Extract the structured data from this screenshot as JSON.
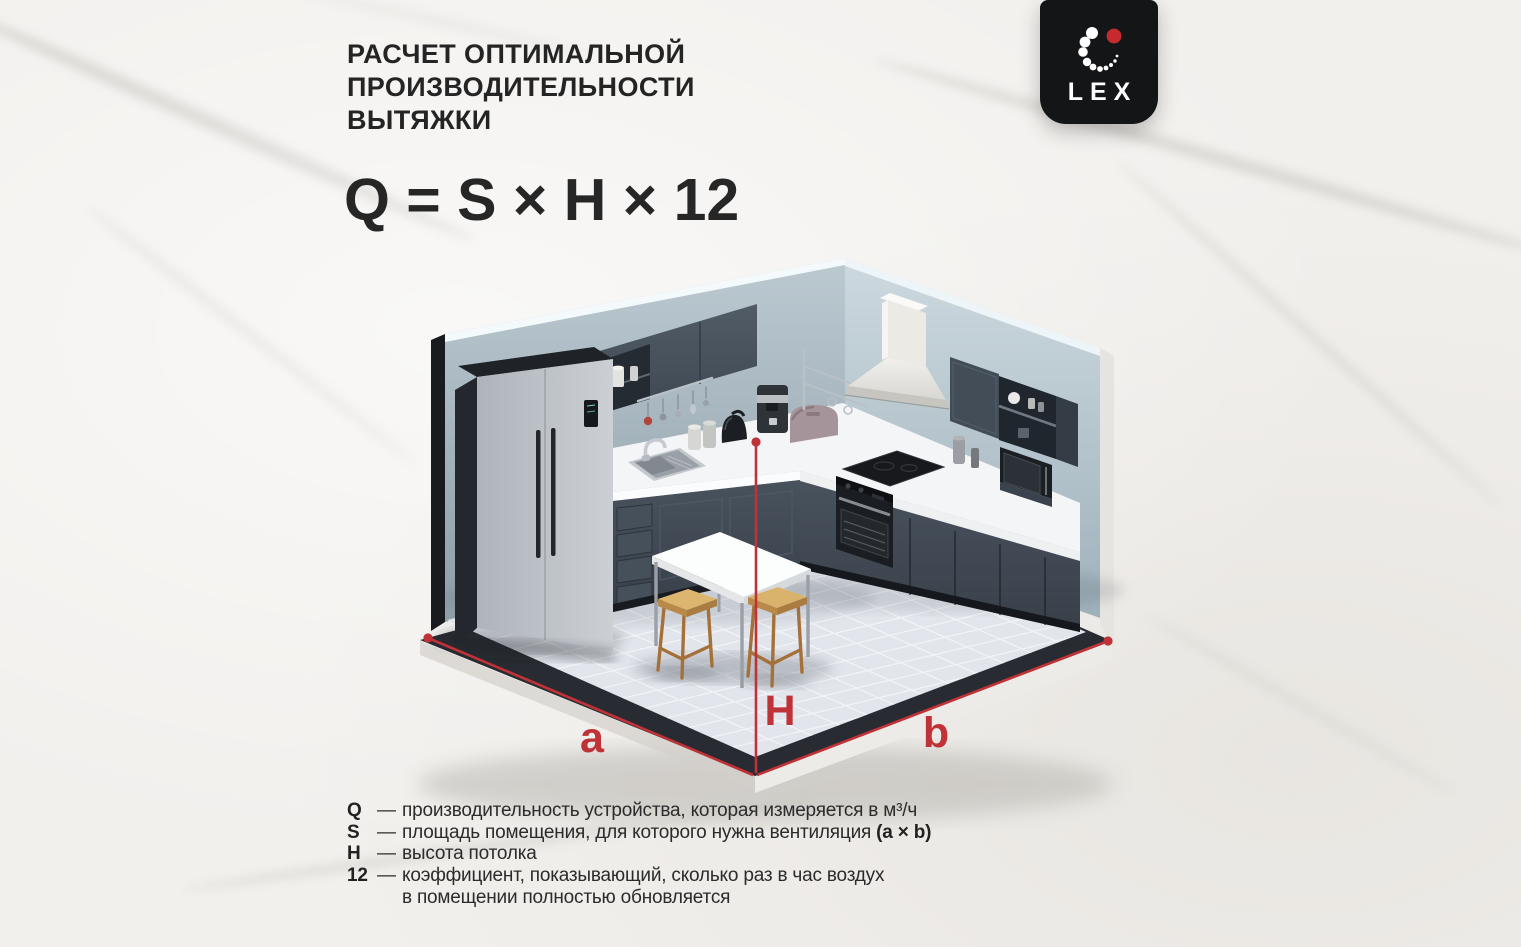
{
  "header": {
    "title_lines": [
      "РАСЧЕТ ОПТИМАЛЬНОЙ",
      "ПРОИЗВОДИТЕЛЬНОСТИ",
      "ВЫТЯЖКИ"
    ],
    "formula": "Q = S × H × 12"
  },
  "logo": {
    "brand": "LEX"
  },
  "diagram": {
    "dimension_labels": {
      "a": "a",
      "b": "b",
      "height": "H"
    }
  },
  "legend": {
    "rows": [
      {
        "symbol": "Q",
        "dash": "—",
        "text": "производительность устройства, которая измеряется в м³/ч",
        "bold_suffix": "",
        "line2": ""
      },
      {
        "symbol": "S",
        "dash": "—",
        "text": "площадь помещения, для которого нужна вентиляция ",
        "bold_suffix": "(a × b)",
        "line2": ""
      },
      {
        "symbol": "H",
        "dash": "—",
        "text": "высота потолка",
        "bold_suffix": "",
        "line2": ""
      },
      {
        "symbol": "12",
        "dash": "—",
        "text": "коэффициент, показывающий, сколько раз в час воздух",
        "bold_suffix": "",
        "line2": "в помещении полностью обновляется"
      }
    ]
  },
  "colors": {
    "accent_red": "#bf3237",
    "text_dark": "#242424",
    "logo_background": "#141517",
    "wall_left": "#a9b8c1",
    "wall_right": "#c2ced5",
    "cabinet_navy": "#424c57",
    "counter_white": "#f4f5f7",
    "hood_steel": "#e9e8e4",
    "floor_tile": "#e2e5ec",
    "platform_dark": "#282b31",
    "stool_wood": "#c89a58",
    "fridge_steel": "#bfc4ca"
  }
}
